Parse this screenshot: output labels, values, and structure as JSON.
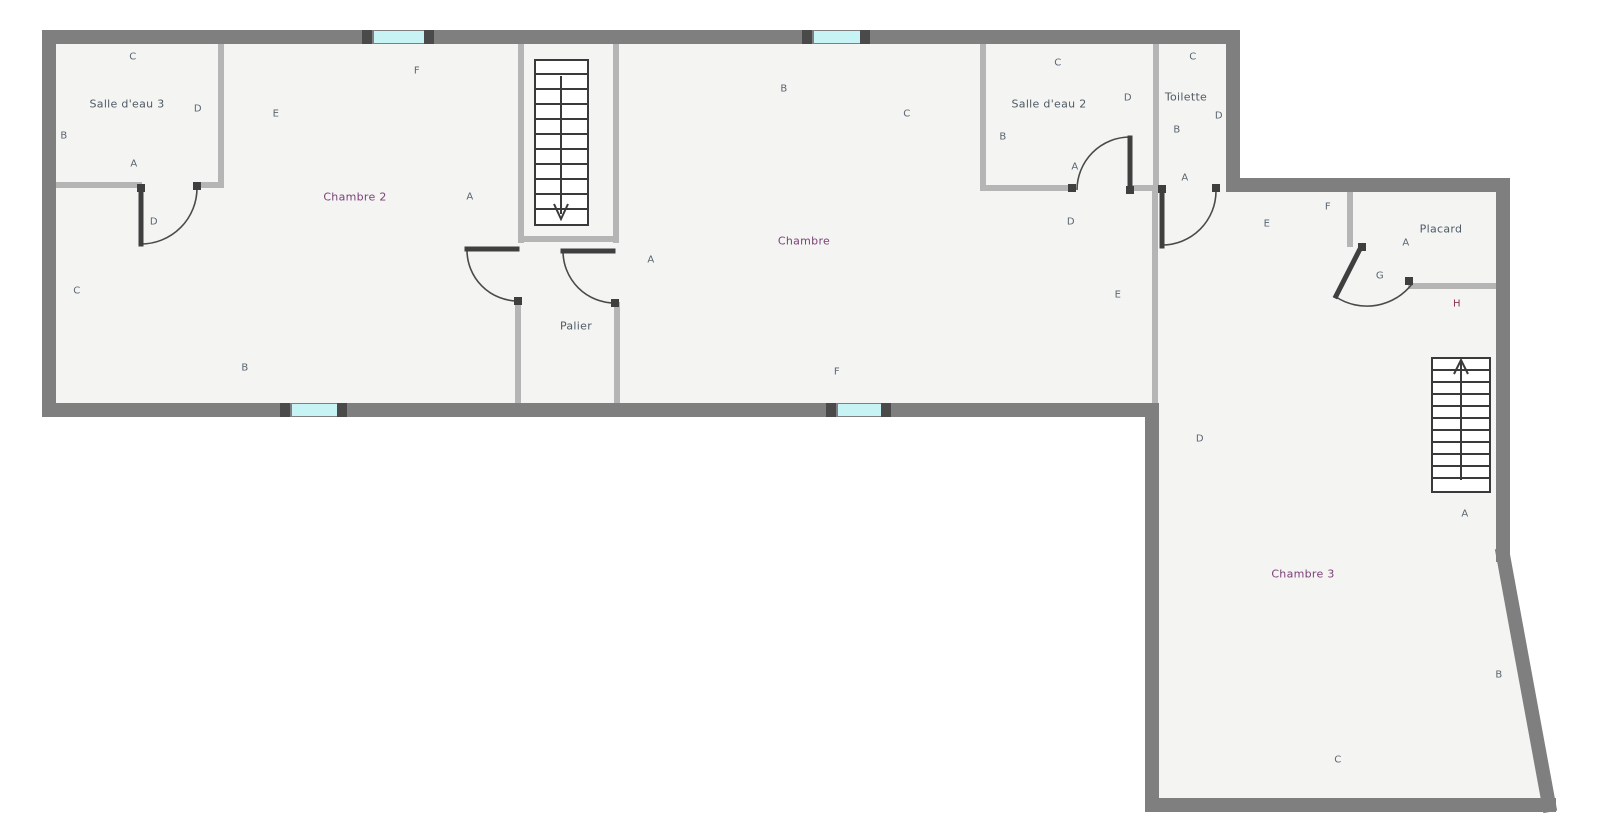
{
  "colors": {
    "outer_wall": "#7f7f7f",
    "inner_wall": "#b5b5b5",
    "door": "#3f3f3f",
    "arc": "#4a4a4a",
    "window_glass": "#c7f3f5",
    "window_cap": "#4a4a4a",
    "floor": "#f4f4f3",
    "stairs_line": "#3a3a3a",
    "label_gray": "#5a6570",
    "room_name_purple": "#7b4076",
    "room_name_gray": "#4e5a64",
    "label_maroon": "#8e3354"
  },
  "rooms": {
    "salle_eau_3": {
      "title": "Salle d'eau 3",
      "wall_c": "C",
      "wall_d": "D",
      "wall_b": "B",
      "wall_a": "A",
      "door_d": "D"
    },
    "chambre_2": {
      "title": "Chambre 2",
      "wall_f": "F",
      "wall_e": "E",
      "wall_a": "A",
      "wall_c": "C",
      "wall_b": "B"
    },
    "palier": {
      "title": "Palier",
      "door_a": "A"
    },
    "chambre": {
      "title": "Chambre",
      "wall_b": "B",
      "wall_c": "C",
      "wall_e": "E",
      "wall_f": "F"
    },
    "salle_eau_2": {
      "title": "Salle d'eau 2",
      "wall_c": "C",
      "wall_d": "D",
      "wall_b": "B",
      "door_a": "A",
      "door_d": "D"
    },
    "toilette": {
      "title": "Toilette",
      "wall_c": "C",
      "wall_b": "B",
      "wall_d": "D",
      "wall_a": "A"
    },
    "placard": {
      "title": "Placard",
      "wall_e": "E",
      "wall_f": "F",
      "wall_a": "A",
      "door_g": "G",
      "wall_h": "H"
    },
    "chambre_3": {
      "title": "Chambre 3",
      "wall_d": "D",
      "wall_a": "A",
      "wall_b": "B",
      "wall_c": "C"
    }
  }
}
